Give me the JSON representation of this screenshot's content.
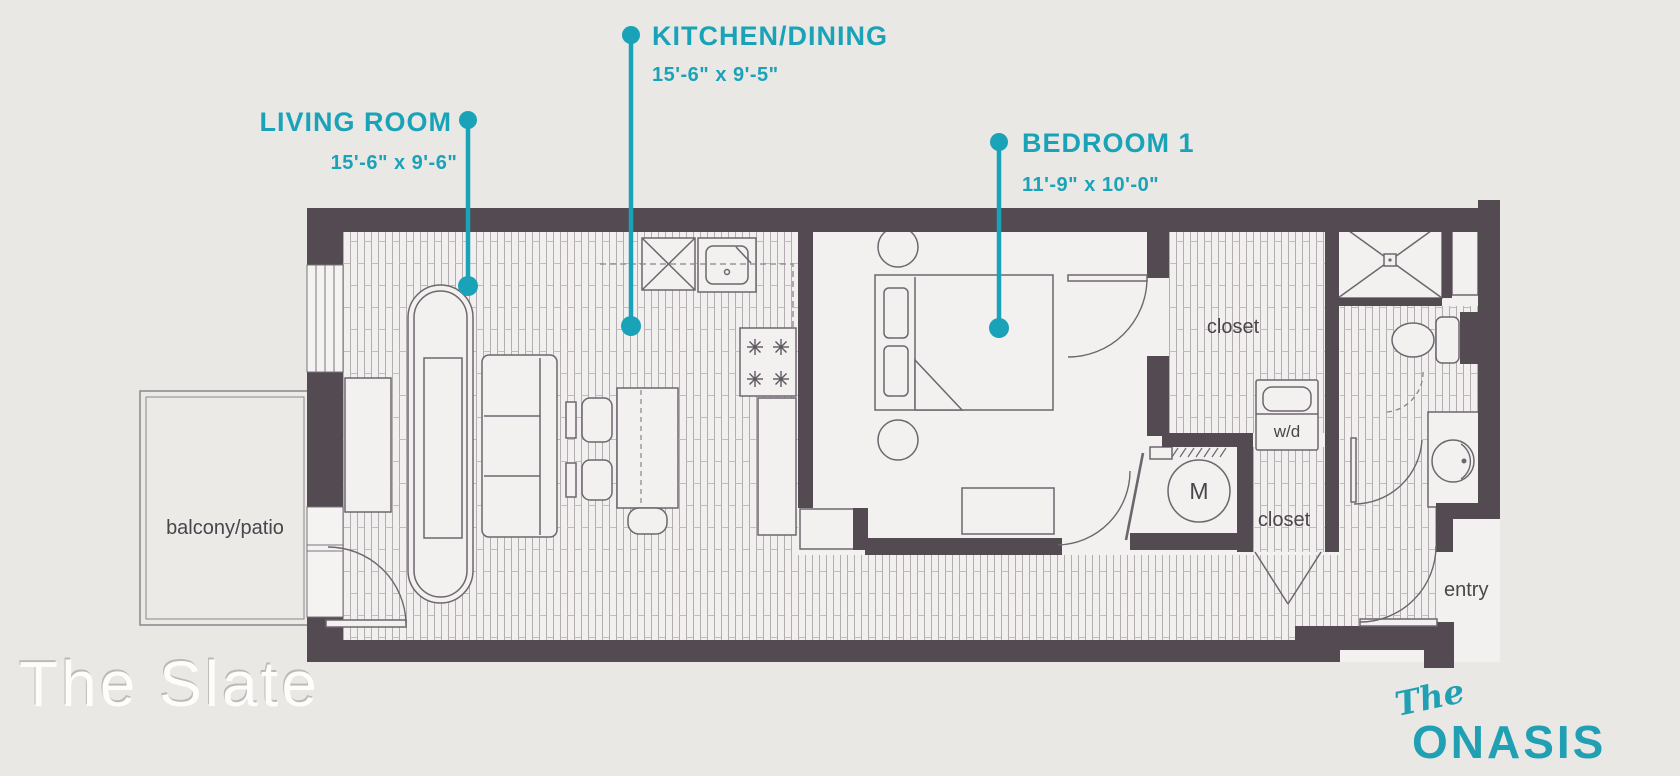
{
  "plan": {
    "living_room": {
      "label": "LIVING ROOM",
      "dims": "15'-6\" x 9'-6\""
    },
    "kitchen_dining": {
      "label": "KITCHEN/DINING",
      "dims": "15'-6\" x 9'-5\""
    },
    "bedroom_1": {
      "label": "BEDROOM 1",
      "dims": "11'-9\" x 10'-0\""
    },
    "rooms": {
      "balcony": "balcony/patio",
      "closet_upper": "closet",
      "closet_lower": "closet",
      "washer_dryer": "w/d",
      "mechanical": "M",
      "entry": "entry"
    }
  },
  "branding": {
    "unit_name": "The Slate",
    "logo_prefix": "The",
    "logo_name": "ONASIS"
  },
  "colors": {
    "accent": "#1aa3b8",
    "wall": "#534a52",
    "background": "#e9e8e5"
  }
}
